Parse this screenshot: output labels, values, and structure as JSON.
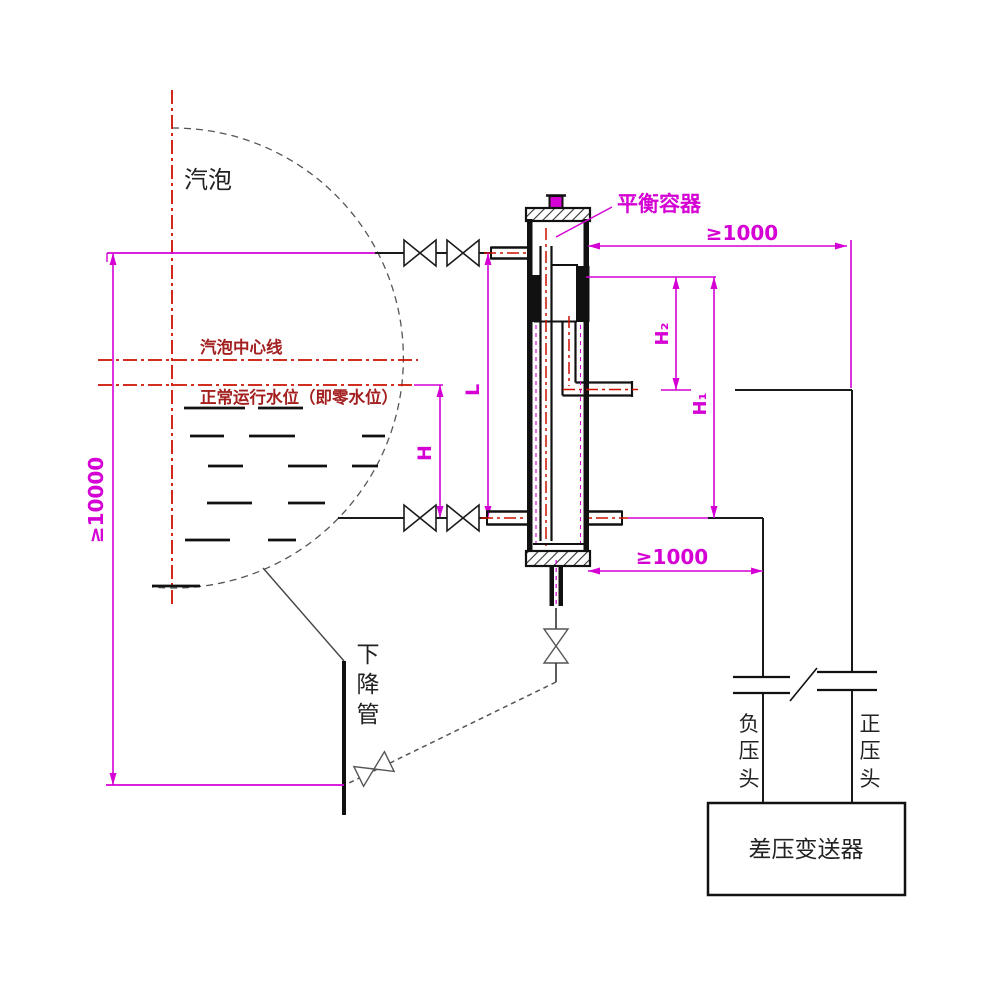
{
  "labels": {
    "drum": "汽泡",
    "drum_centerline": "汽泡中心线",
    "normal_water_level": "正常运行水位（即零水位）",
    "balance_vessel": "平衡容器",
    "downcomer_chars": [
      "下",
      "降",
      "管"
    ],
    "negative_head_chars": [
      "负",
      "压",
      "头"
    ],
    "positive_head_chars": [
      "正",
      "压",
      "头"
    ],
    "transmitter": "差压变送器"
  },
  "dimensions": {
    "drum_to_downcomer_height": "≥10000",
    "vessel_to_downpipe_offset_top": "≥1000",
    "vessel_to_downpipe_offset_bottom": "≥1000",
    "h": "H",
    "l": "L",
    "h2": "H₂",
    "h1": "H₁"
  },
  "colors": {
    "dimension_magenta": "#d400d4",
    "centerline_red": "#cc1100",
    "level_label_red": "#a32020",
    "line_black": "#1a1a1a",
    "arc_gray": "#555555"
  }
}
